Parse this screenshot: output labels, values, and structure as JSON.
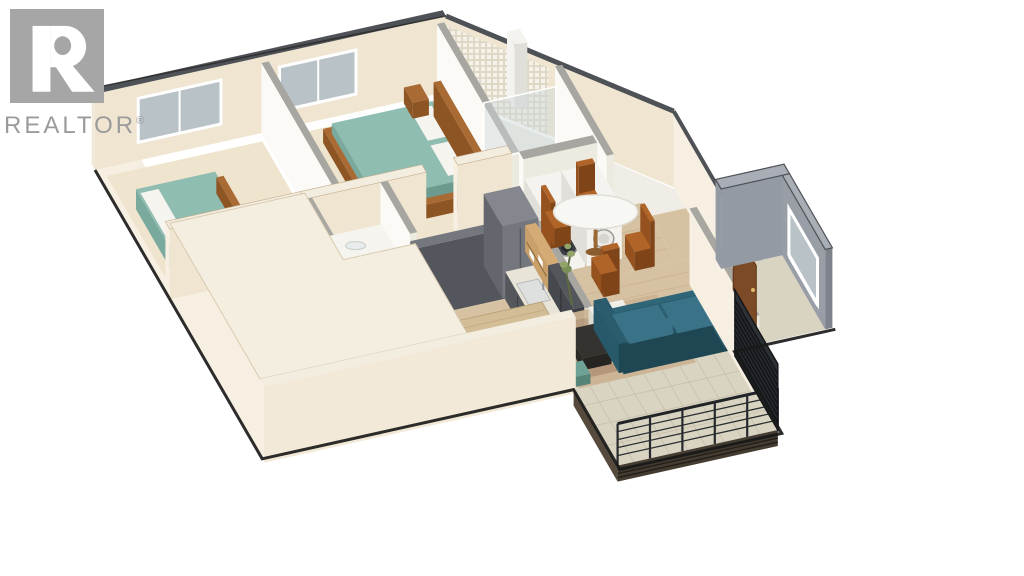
{
  "background": "#ffffff",
  "logo": {
    "wordmark": "REALTOR",
    "registered": "®",
    "icon": "realtor-r-icon",
    "square_color": "#a6a6a6",
    "text_color": "#9b9b9b"
  },
  "scene": {
    "type": "isometric-3d-floor-plan",
    "layers": [
      "structure-back",
      "floors",
      "bedroom-1",
      "bedroom-2",
      "shower-room",
      "hallway",
      "bathroom",
      "laundry",
      "kitchen",
      "dining-area",
      "living-room",
      "entry",
      "structure-front",
      "balcony",
      "outline"
    ],
    "rooms": [
      "bedroom-1",
      "bedroom-2",
      "bathroom",
      "shower-room",
      "laundry",
      "hallway",
      "kitchen",
      "dining-area",
      "living-room",
      "balcony",
      "entry"
    ],
    "furniture": [
      "bed",
      "bed-with-headboard",
      "nightstand",
      "vanity",
      "toilet",
      "shower",
      "washer",
      "dryer",
      "kitchen-cabinets",
      "refrigerator",
      "oven",
      "cooktop",
      "sink",
      "kitchen-island",
      "bar-stool",
      "dining-table",
      "dining-chair",
      "sofa",
      "coffee-table",
      "area-rug",
      "plant",
      "pouf",
      "balcony-railing",
      "entry-door",
      "window"
    ],
    "palette": {
      "outline": "#1a1a1a",
      "wall_cream": "#f2e9d8",
      "wall_cream_lit": "#f7f0e2",
      "wall_cream_shadow": "#e7d9c1",
      "wall_face": "#efe5d0",
      "wall_top_light": "#f3ede0",
      "wall_top_interior": "#a8a6a1",
      "wall_cap_dark": "#4e5156",
      "wall_white": "#fbfaf6",
      "wall_white_shadow": "#edeadf",
      "wall_charcoal": "#53565c",
      "wall_charcoal_side": "#45484e",
      "wall_charcoal_top": "#74777d",
      "wall_gray": "#949aa3",
      "wall_gray_dark": "#7d828b",
      "wall_gray_top": "#a9aeb6",
      "floor_wood": "#d6c2a2",
      "floor_wood_line": "#c3ac8b",
      "floor_carpet": "#efe4cd",
      "floor_bath": "#efede6",
      "floor_tile": "#d9d3c2",
      "floor_tile_line": "#c7bfab",
      "glass": "#b9c3c7",
      "frame_white": "#ffffff",
      "bed_teal": "#8fbdb2",
      "bed_teal_side": "#7aa99e",
      "bed_teal_front": "#6c9a8f",
      "pillow_white": "#f6f4ee",
      "wood_furniture": "#a96b33",
      "wood_furniture_dark": "#8d5524",
      "chair_brown": "#b06428",
      "chair_brown_side": "#95521f",
      "chair_brown_front": "#7f4519",
      "sofa_teal": "#2f6779",
      "sofa_teal_dark": "#27596a",
      "sofa_teal_cushion": "#3a7388",
      "appliance_white": "#f4f3ef",
      "appliance_shadow": "#e0dfd9",
      "washer_door": "#3c4046",
      "cabinet_dark": "#4a4d52",
      "cabinet_side": "#54575c",
      "cabinet_upper": "#3b3e43",
      "counter_light": "#e9e4d8",
      "cooktop": "#25272b",
      "shelf_wood": "#c9a06a",
      "shelf_wood_dark": "#b08244",
      "island_top": "#d3bd96",
      "island_side": "#6d7176",
      "island_end": "#777b80",
      "stool_seat": "#d6d8da",
      "stool_leg": "#8a6a44",
      "table_white": "#f7f7f4",
      "rug_a": "#cbb393",
      "rug_b": "#bea083",
      "rug_c": "#d6c6a8",
      "rug_d": "#b29478",
      "plant_green": "#7a8f56",
      "plant_green_light": "#93a468",
      "railing_dark": "#26292d",
      "deck_fascia": "#453c31",
      "door_brown": "#7b4a26",
      "mosaic_line": "#ddd6c6"
    }
  }
}
